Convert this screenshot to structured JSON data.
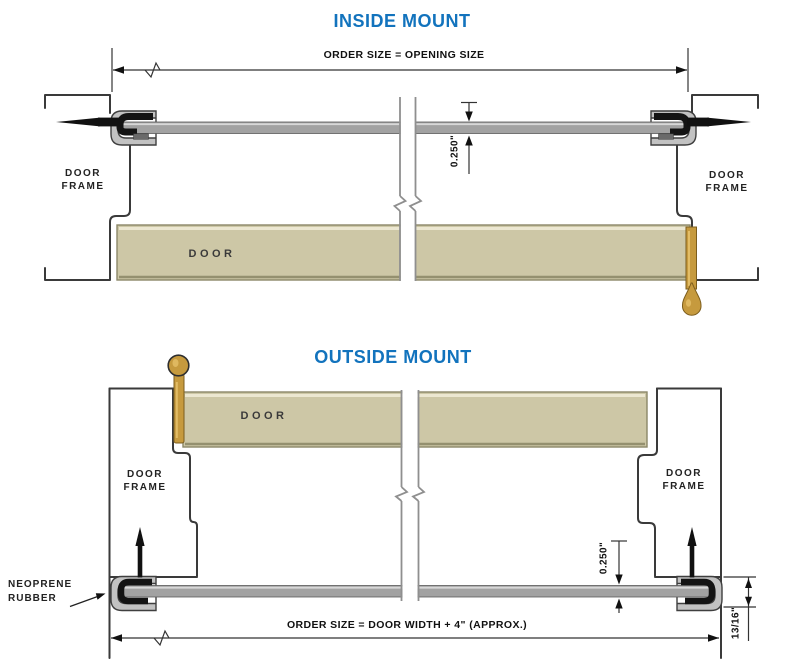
{
  "inside_mount": {
    "title": "INSIDE MOUNT",
    "order_dimension": "ORDER SIZE = OPENING SIZE",
    "rail_thickness_dimension": "0.250\"",
    "door_label": "DOOR",
    "left_frame_label": "DOOR\nFRAME",
    "right_frame_label": "DOOR\nFRAME"
  },
  "outside_mount": {
    "title": "OUTSIDE MOUNT",
    "order_dimension": "ORDER SIZE = DOOR WIDTH + 4\" (APPROX.)",
    "rail_thickness_dimension": "0.250\"",
    "housing_height_dimension": "13/16\"",
    "door_label": "DOOR",
    "left_frame_label": "DOOR\nFRAME",
    "right_frame_label": "DOOR\nFRAME",
    "neoprene_label": "NEOPRENE\nRUBBER"
  },
  "colors": {
    "title_blue": "#1273bd",
    "door_beige": "#cdc7a6",
    "rail_gray": "#a2a2a2",
    "handle_gold": "#c69a3e",
    "line_dark": "#3a3a3a"
  }
}
